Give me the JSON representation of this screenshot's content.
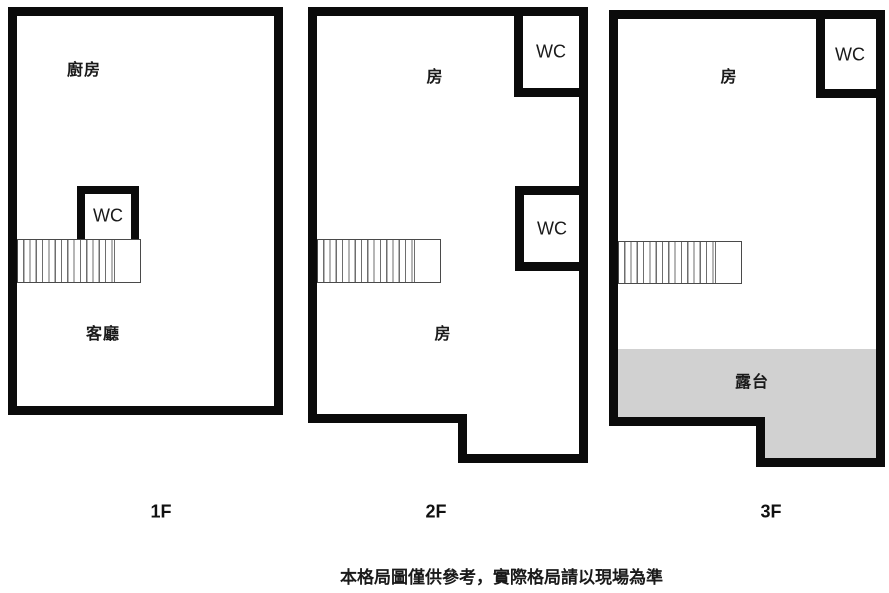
{
  "title": "floor-plan-diagram",
  "disclaimer": "本格局圖僅供參考，實際格局請以現場為準",
  "colors": {
    "wall": "#0b0b0b",
    "terrace_fill": "#d1d1d1",
    "stair_line": "#6e6e6e",
    "text": "#1a1a1a",
    "background": "#ffffff"
  },
  "floors": [
    {
      "id": "1f",
      "label": "1F",
      "rooms": [
        {
          "name": "kitchen",
          "label": "廚房"
        },
        {
          "name": "wc",
          "label": "WC"
        },
        {
          "name": "living-room",
          "label": "客廳"
        }
      ]
    },
    {
      "id": "2f",
      "label": "2F",
      "rooms": [
        {
          "name": "room-upper",
          "label": "房"
        },
        {
          "name": "wc-top",
          "label": "WC"
        },
        {
          "name": "wc-middle",
          "label": "WC"
        },
        {
          "name": "room-lower",
          "label": "房"
        }
      ]
    },
    {
      "id": "3f",
      "label": "3F",
      "rooms": [
        {
          "name": "room",
          "label": "房"
        },
        {
          "name": "wc",
          "label": "WC"
        },
        {
          "name": "terrace",
          "label": "露台"
        }
      ]
    }
  ]
}
